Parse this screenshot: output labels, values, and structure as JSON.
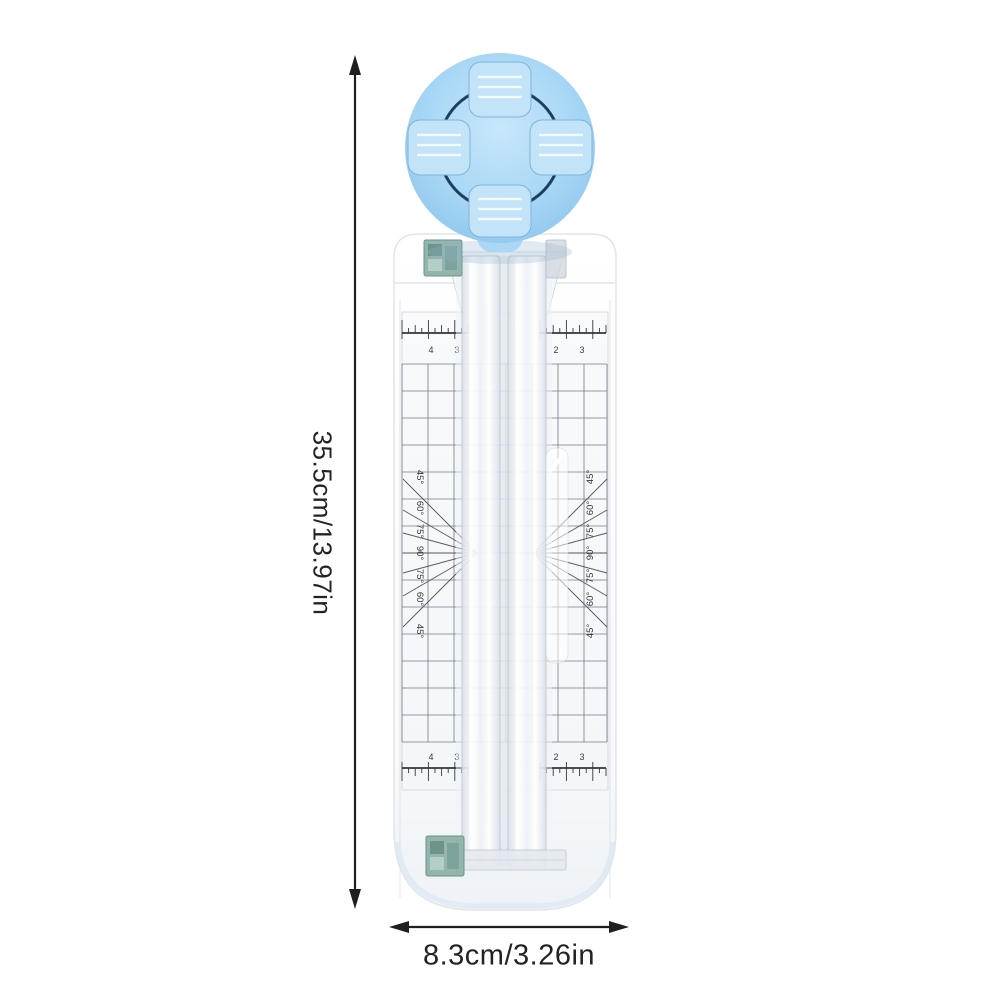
{
  "annotations": {
    "height_label": "35.5cm/13.97in",
    "width_label": "8.3cm/3.26in"
  },
  "trimmer": {
    "angle_labels_left": [
      "45°",
      "60°",
      "75°",
      "90°",
      "75°",
      "60°",
      "45°"
    ],
    "angle_labels_right": [
      "45°",
      "60°",
      "75°",
      "90°",
      "75°",
      "60°",
      "45°"
    ],
    "scales": {
      "top": {
        "left_numbers": [
          "4",
          "3"
        ],
        "right_numbers": [
          "2",
          "3"
        ]
      },
      "bottom": {
        "left_numbers": [
          "4",
          "3"
        ],
        "right_numbers": [
          "2",
          "3"
        ]
      }
    },
    "colors": {
      "knob_blue": "#a9d7f4",
      "knob_tab_blue": "#c2e3f8",
      "knob_outline_navy": "#1f3f5e",
      "body_white": "#fbfcfd",
      "clip_teal": "#8fb6ae",
      "grid_gray": "#5f6570",
      "annotation_black": "#1f1f1f"
    }
  }
}
